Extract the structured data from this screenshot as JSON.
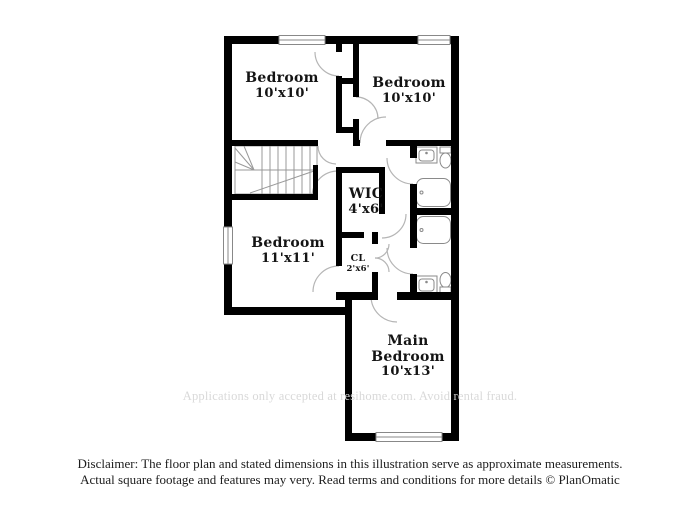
{
  "plan": {
    "rooms": [
      {
        "name": "Bedroom",
        "dims": "10'x10'"
      },
      {
        "name": "Bedroom",
        "dims": "10'x10'"
      },
      {
        "name": "Bedroom",
        "dims": "11'x11'"
      },
      {
        "name": "WIC",
        "dims": "4'x6'"
      },
      {
        "name": "CL",
        "dims": "2'x6'"
      },
      {
        "name": "Main Bedroom",
        "dims": "10'x13'"
      }
    ],
    "watermark": "Applications only accepted at resihome.com. Avoid rental fraud."
  },
  "footer": {
    "disclaimer_line1": "Disclaimer: The floor plan and stated dimensions in this illustration serve as approximate measurements.",
    "disclaimer_line2": "Actual square footage and features may very. Read terms and conditions for more details © PlanOmatic"
  },
  "colors": {
    "wall": "#000000",
    "fixture_outline": "#8a8a8a",
    "door_arc": "#b5b5b5",
    "watermark_text": "#d9d9d9",
    "label_text": "#141414"
  }
}
